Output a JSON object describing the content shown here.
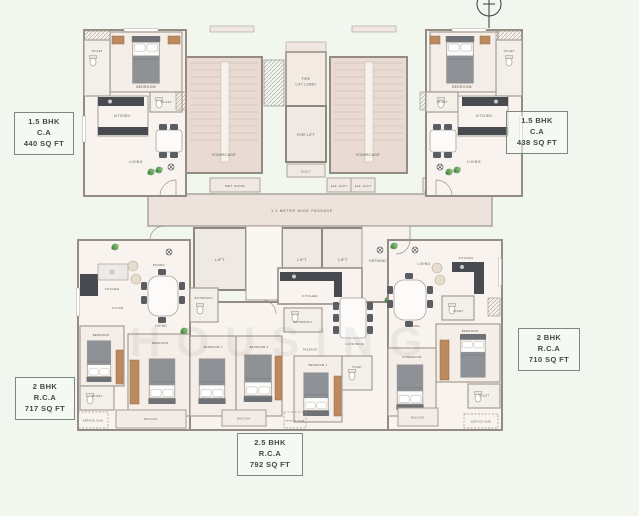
{
  "units": [
    {
      "id": "unit-top-left",
      "bhk": "1.5 BHK",
      "basis": "C.A",
      "area": "440 SQ FT"
    },
    {
      "id": "unit-top-right",
      "bhk": "1.5 BHK",
      "basis": "C.A",
      "area": "438 SQ FT"
    },
    {
      "id": "unit-bottom-left",
      "bhk": "2 BHK",
      "basis": "R.C.A",
      "area": "717 SQ FT"
    },
    {
      "id": "unit-bottom-right",
      "bhk": "2 BHK",
      "basis": "R.C.A",
      "area": "710 SQ FT"
    },
    {
      "id": "unit-bottom-middle",
      "bhk": "2.5 BHK",
      "basis": "R.C.A",
      "area": "792 SQ FT"
    }
  ],
  "core": {
    "staircase_left": "STAIRCASE",
    "staircase_right": "STAIRCASE",
    "fire_lift_lobby_line1": "FIRE",
    "fire_lift_lobby_line2": "LIFT LOBBY",
    "fire_lift": "FIRE LIFT",
    "duct": "DUCT",
    "met_room": "MET. ROOM",
    "ele_duct_1": "ELE. DUCT",
    "ele_duct_2": "ELE. DUCT",
    "ele_duct_3": "ELE. DUCT",
    "ele_duct_4": "ELE. DUCT",
    "passage": "1.2 METER WIDE PASSAGE",
    "lift_1": "LIFT",
    "lift_2": "LIFT",
    "lift_3": "LIFT",
    "entrance_lobby": "ENTRANCE LOBBY"
  },
  "rooms": {
    "tl": {
      "bedroom": "BEDROOM",
      "toilet": "TOILET",
      "toilet2": "TOILET",
      "kitchen": "KITCHEN",
      "living": "LIVING"
    },
    "tr": {
      "bedroom": "BEDROOM",
      "toilet": "TOILET",
      "toilet2": "TOILET",
      "kitchen": "KITCHEN",
      "living": "LIVING"
    },
    "bl": {
      "dining": "DINING",
      "living": "LIVING",
      "foyer": "FOYER",
      "kitchen": "KITCHEN",
      "bedroom1": "BEDROOM",
      "bedroom2": "BEDROOM",
      "toilet": "TOILET",
      "service": "SERVICE SLAB",
      "balcony": "BALCONY"
    },
    "bm": {
      "kitchen": "KITCHEN",
      "bath1": "BATHROOM 1",
      "bath2": "BATHROOM 2",
      "livdining": "LIV/DINING",
      "passage": "PASSAGE",
      "bedroom1": "BEDROOM 1",
      "bedroom2": "BEDROOM 2",
      "bedroom3": "BEDROOM 3",
      "toilet": "TOILET",
      "service": "SERVICE SLAB",
      "balcony": "BALCONY"
    },
    "br": {
      "living": "LIVING",
      "dining": "DINING",
      "kitchen": "KITCHEN",
      "toilet": "TOILET",
      "toilet2": "TOILET",
      "bedroom": "BEDROOM",
      "mbedroom": "M.BEDROOM",
      "service": "SERVICE SLAB",
      "balcony": "BALCONY"
    }
  },
  "watermark": "HOUSING",
  "colors": {
    "background": "#f1f6ef",
    "wall": "#a59d94",
    "stair_fill": "#e9dbd3",
    "common_fill": "#eee3dc",
    "furniture_dark": "#474b4f",
    "wood": "#bd8a5f",
    "plant": "#5f9e58",
    "label_text": "#4a554f"
  }
}
